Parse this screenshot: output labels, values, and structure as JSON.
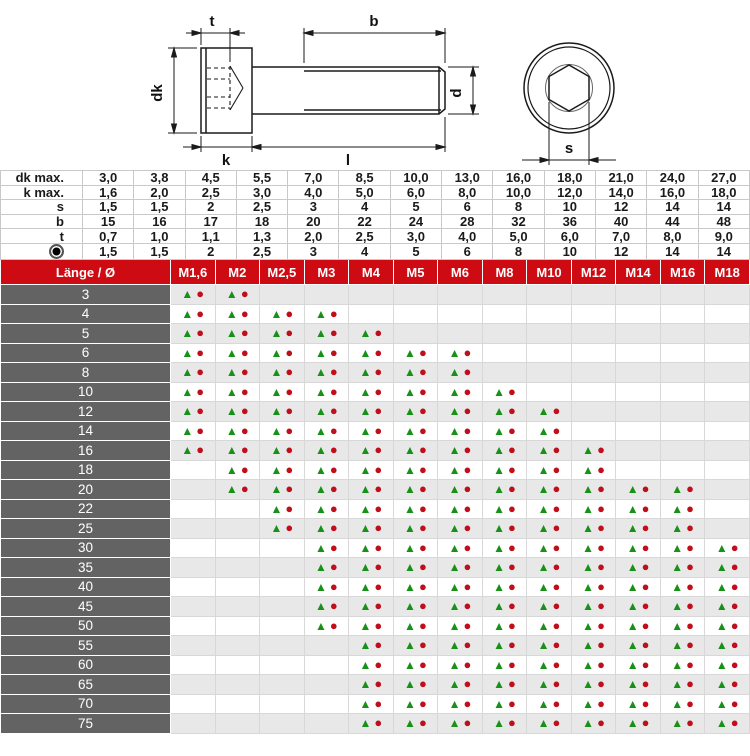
{
  "diagram": {
    "labels": {
      "t": "t",
      "b": "b",
      "dk": "dk",
      "d": "d",
      "k": "k",
      "l": "l",
      "s": "s"
    }
  },
  "spec_table": {
    "rows": [
      {
        "label": "dk max.",
        "values": [
          "3,0",
          "3,8",
          "4,5",
          "5,5",
          "7,0",
          "8,5",
          "10,0",
          "13,0",
          "16,0",
          "18,0",
          "21,0",
          "24,0",
          "27,0"
        ]
      },
      {
        "label": "k max.",
        "values": [
          "1,6",
          "2,0",
          "2,5",
          "3,0",
          "4,0",
          "5,0",
          "6,0",
          "8,0",
          "10,0",
          "12,0",
          "14,0",
          "16,0",
          "18,0"
        ]
      },
      {
        "label": "s",
        "values": [
          "1,5",
          "1,5",
          "2",
          "2,5",
          "3",
          "4",
          "5",
          "6",
          "8",
          "10",
          "12",
          "14",
          "14"
        ]
      },
      {
        "label": "b",
        "values": [
          "15",
          "16",
          "17",
          "18",
          "20",
          "22",
          "24",
          "28",
          "32",
          "36",
          "40",
          "44",
          "48"
        ]
      },
      {
        "label": "t",
        "values": [
          "0,7",
          "1,0",
          "1,1",
          "1,3",
          "2,0",
          "2,5",
          "3,0",
          "4,0",
          "5,0",
          "6,0",
          "7,0",
          "8,0",
          "9,0"
        ]
      },
      {
        "label": "",
        "icon": "bullseye-icon",
        "values": [
          "1,5",
          "1,5",
          "2",
          "2,5",
          "3",
          "4",
          "5",
          "6",
          "8",
          "10",
          "12",
          "14",
          "14"
        ]
      }
    ]
  },
  "matrix": {
    "corner_label": "Länge / Ø",
    "columns": [
      "M1,6",
      "M2",
      "M2,5",
      "M3",
      "M4",
      "M5",
      "M6",
      "M8",
      "M10",
      "M12",
      "M14",
      "M16",
      "M18"
    ],
    "symbols": {
      "triangle": "▲",
      "circle": "●"
    },
    "rows": [
      {
        "length": "3",
        "marks": [
          1,
          1,
          0,
          0,
          0,
          0,
          0,
          0,
          0,
          0,
          0,
          0,
          0
        ]
      },
      {
        "length": "4",
        "marks": [
          1,
          1,
          1,
          1,
          0,
          0,
          0,
          0,
          0,
          0,
          0,
          0,
          0
        ]
      },
      {
        "length": "5",
        "marks": [
          1,
          1,
          1,
          1,
          1,
          0,
          0,
          0,
          0,
          0,
          0,
          0,
          0
        ]
      },
      {
        "length": "6",
        "marks": [
          1,
          1,
          1,
          1,
          1,
          1,
          1,
          0,
          0,
          0,
          0,
          0,
          0
        ]
      },
      {
        "length": "8",
        "marks": [
          1,
          1,
          1,
          1,
          1,
          1,
          1,
          0,
          0,
          0,
          0,
          0,
          0
        ]
      },
      {
        "length": "10",
        "marks": [
          1,
          1,
          1,
          1,
          1,
          1,
          1,
          1,
          0,
          0,
          0,
          0,
          0
        ]
      },
      {
        "length": "12",
        "marks": [
          1,
          1,
          1,
          1,
          1,
          1,
          1,
          1,
          1,
          0,
          0,
          0,
          0
        ]
      },
      {
        "length": "14",
        "marks": [
          1,
          1,
          1,
          1,
          1,
          1,
          1,
          1,
          1,
          0,
          0,
          0,
          0
        ]
      },
      {
        "length": "16",
        "marks": [
          1,
          1,
          1,
          1,
          1,
          1,
          1,
          1,
          1,
          1,
          0,
          0,
          0
        ]
      },
      {
        "length": "18",
        "marks": [
          0,
          1,
          1,
          1,
          1,
          1,
          1,
          1,
          1,
          1,
          0,
          0,
          0
        ]
      },
      {
        "length": "20",
        "marks": [
          0,
          1,
          1,
          1,
          1,
          1,
          1,
          1,
          1,
          1,
          1,
          1,
          0
        ]
      },
      {
        "length": "22",
        "marks": [
          0,
          0,
          1,
          1,
          1,
          1,
          1,
          1,
          1,
          1,
          1,
          1,
          0
        ]
      },
      {
        "length": "25",
        "marks": [
          0,
          0,
          1,
          1,
          1,
          1,
          1,
          1,
          1,
          1,
          1,
          1,
          0
        ]
      },
      {
        "length": "30",
        "marks": [
          0,
          0,
          0,
          1,
          1,
          1,
          1,
          1,
          1,
          1,
          1,
          1,
          1
        ]
      },
      {
        "length": "35",
        "marks": [
          0,
          0,
          0,
          1,
          1,
          1,
          1,
          1,
          1,
          1,
          1,
          1,
          1
        ]
      },
      {
        "length": "40",
        "marks": [
          0,
          0,
          0,
          1,
          1,
          1,
          1,
          1,
          1,
          1,
          1,
          1,
          1
        ]
      },
      {
        "length": "45",
        "marks": [
          0,
          0,
          0,
          1,
          1,
          1,
          1,
          1,
          1,
          1,
          1,
          1,
          1
        ]
      },
      {
        "length": "50",
        "marks": [
          0,
          0,
          0,
          1,
          1,
          1,
          1,
          1,
          1,
          1,
          1,
          1,
          1
        ]
      },
      {
        "length": "55",
        "marks": [
          0,
          0,
          0,
          0,
          1,
          1,
          1,
          1,
          1,
          1,
          1,
          1,
          1
        ]
      },
      {
        "length": "60",
        "marks": [
          0,
          0,
          0,
          0,
          1,
          1,
          1,
          1,
          1,
          1,
          1,
          1,
          1
        ]
      },
      {
        "length": "65",
        "marks": [
          0,
          0,
          0,
          0,
          1,
          1,
          1,
          1,
          1,
          1,
          1,
          1,
          1
        ]
      },
      {
        "length": "70",
        "marks": [
          0,
          0,
          0,
          0,
          1,
          1,
          1,
          1,
          1,
          1,
          1,
          1,
          1
        ]
      },
      {
        "length": "75",
        "marks": [
          0,
          0,
          0,
          0,
          1,
          1,
          1,
          1,
          1,
          1,
          1,
          1,
          1
        ]
      }
    ]
  },
  "colors": {
    "header-red": "#ce0a12",
    "label-gray": "#636363",
    "row-alt-gray": "#e8e8e8",
    "triangle-green": "#179117",
    "circle-red": "#c10e1b"
  }
}
